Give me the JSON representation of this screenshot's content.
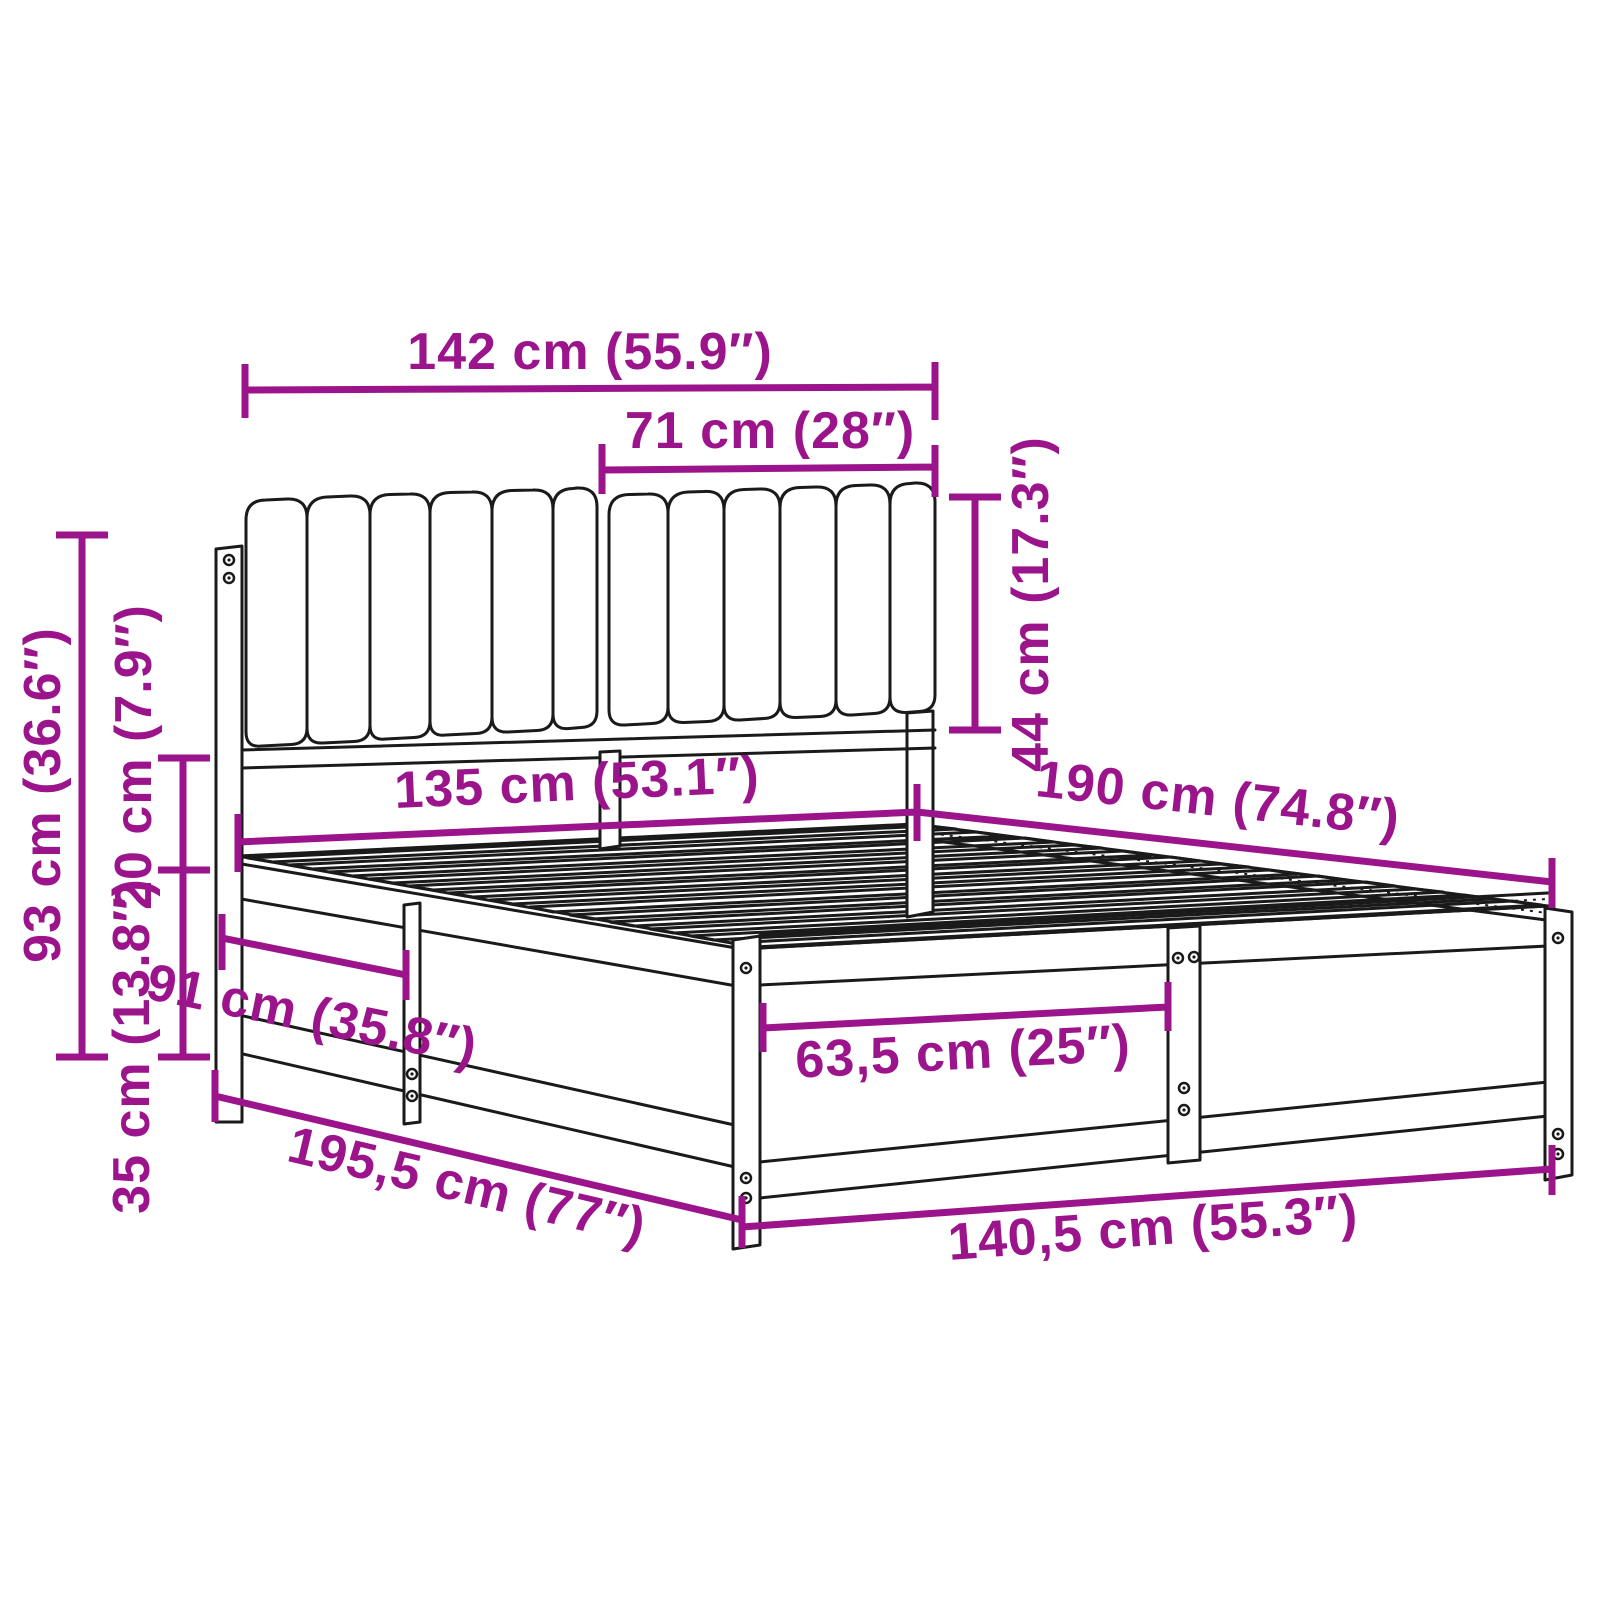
{
  "diagram": {
    "type": "product-dimension-diagram",
    "subject": "bed-frame-with-upholstered-headboard",
    "accent_color": "#9B148B",
    "line_color": "#1a1a1a",
    "background_color": "#ffffff",
    "units": "cm / inches"
  },
  "dimensions": {
    "headboard_width": {
      "label": "142 cm (55.9″)",
      "cm": 142,
      "inches": 55.9
    },
    "headboard_half_width": {
      "label": "71 cm (28″)",
      "cm": 71,
      "inches": 28
    },
    "cushion_height": {
      "label": "44 cm (17.3″)",
      "cm": 44,
      "inches": 17.3
    },
    "headboard_total_height": {
      "label": "93 cm (36.6″)",
      "cm": 93,
      "inches": 36.6
    },
    "cushion_gap_height": {
      "label": "20 cm (7.9″)",
      "cm": 20,
      "inches": 7.9
    },
    "frame_side_height": {
      "label": "35 cm (13.8″)",
      "cm": 35,
      "inches": 13.8
    },
    "inner_width": {
      "label": "135 cm (53.1″)",
      "cm": 135,
      "inches": 53.1
    },
    "inner_length": {
      "label": "190 cm (74.8″)",
      "cm": 190,
      "inches": 74.8
    },
    "side_section_length": {
      "label": "91 cm (35.8″)",
      "cm": 91,
      "inches": 35.8
    },
    "front_section_width": {
      "label": "63,5 cm (25″)",
      "cm": 63.5,
      "inches": 25
    },
    "total_length": {
      "label": "195,5 cm (77″)",
      "cm": 195.5,
      "inches": 77
    },
    "total_width": {
      "label": "140,5 cm (55.3″)",
      "cm": 140.5,
      "inches": 55.3
    }
  }
}
